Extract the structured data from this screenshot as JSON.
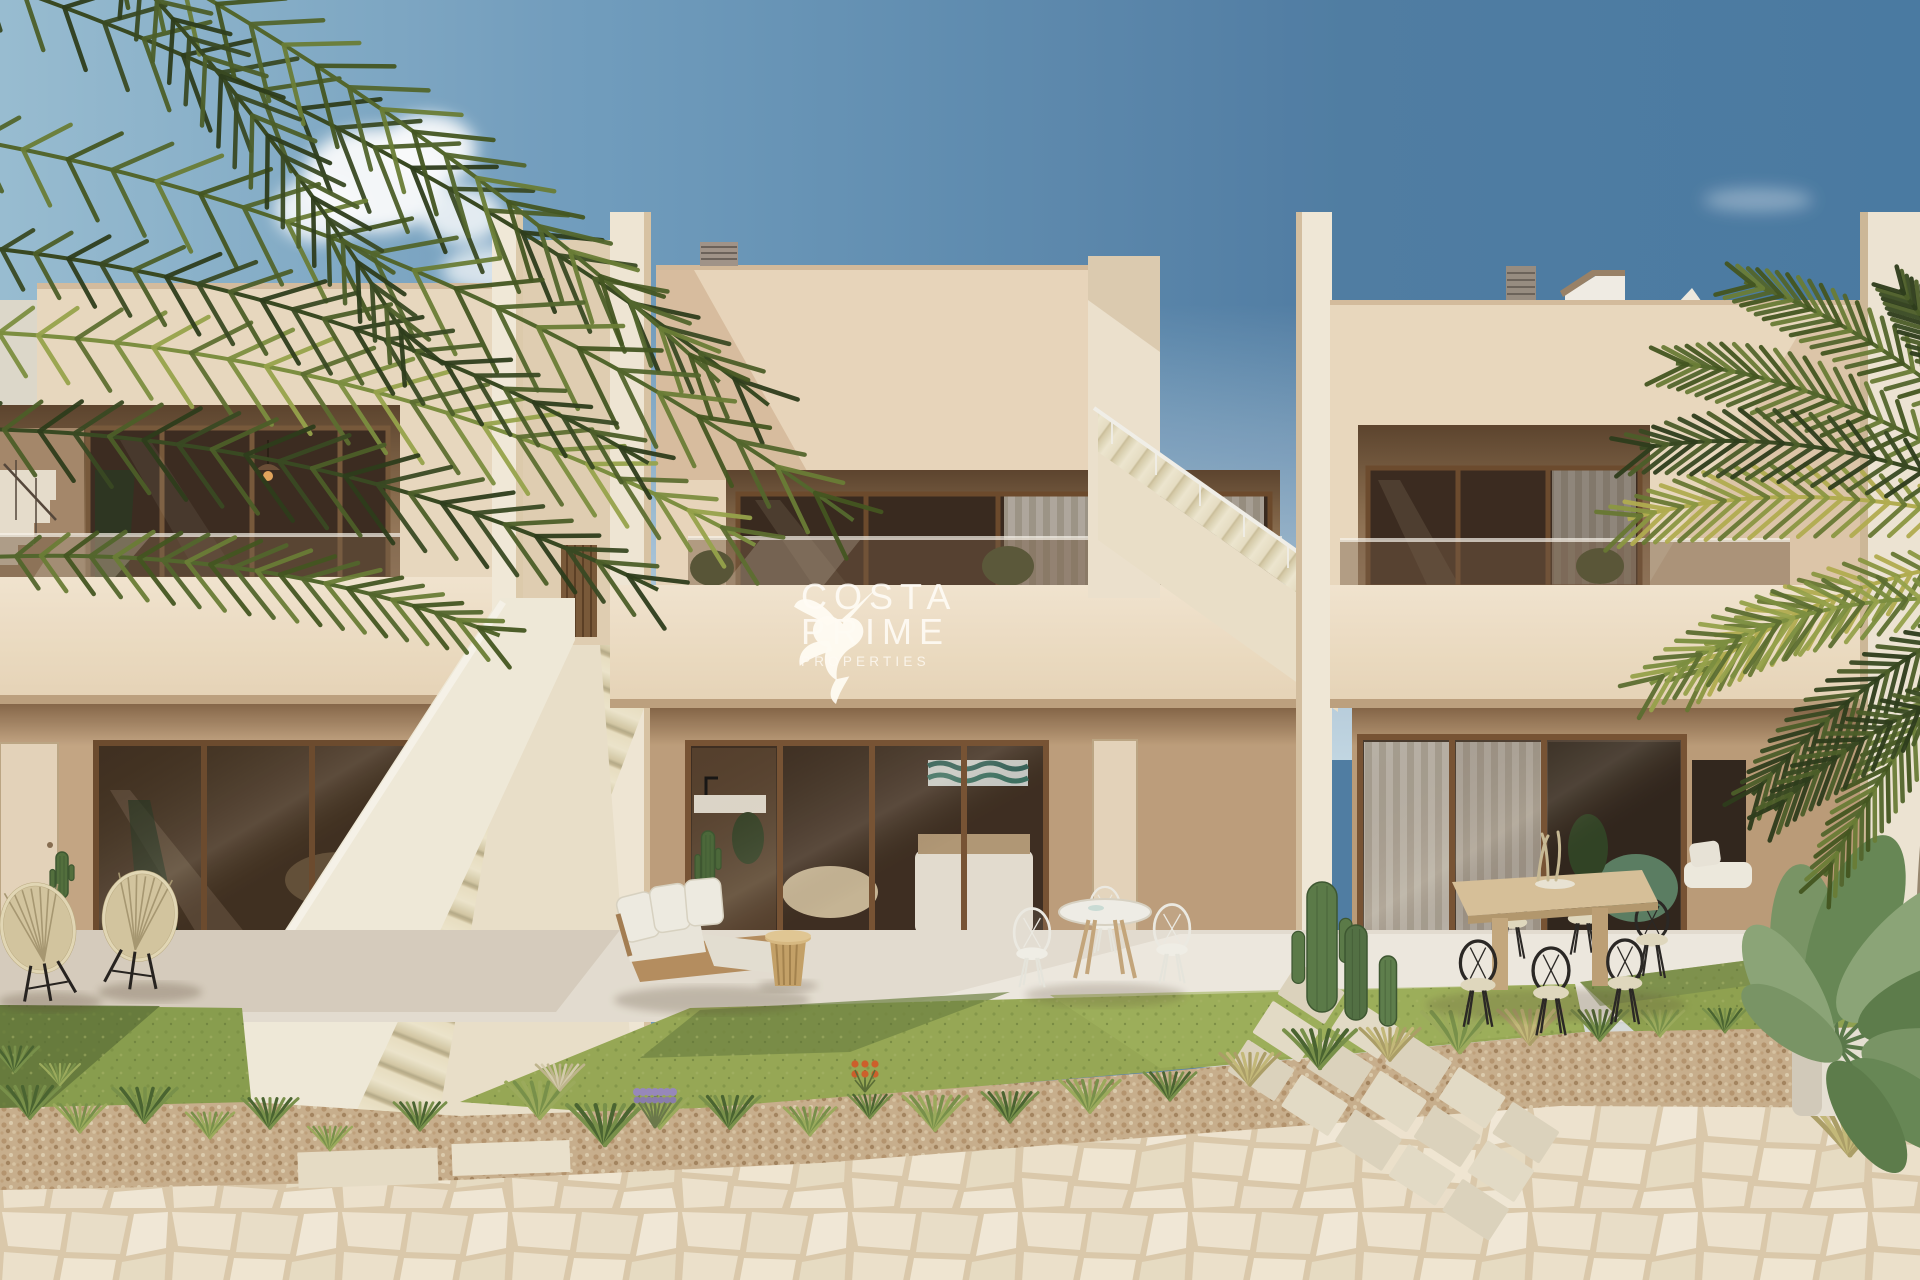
{
  "watermark": {
    "brand_line1": "COSTA",
    "brand_line2": "PRIME",
    "brand_line3": "PROPERTIES",
    "logo_icon": "hummingbird-icon",
    "color": "#FFFFFF"
  },
  "palette": {
    "sky_deep_blue": "#4f82aa",
    "sky_light_blue": "#a6c6da",
    "wall_lit_cream": "#f2e4cb",
    "wall_tan_shade": "#c7a884",
    "recess_brown": "#6e5138",
    "glass_frame_brown": "#6f4c2d",
    "glass_dark": "#3d2c1f",
    "lawn_green": "#97a751",
    "gravel_tan": "#cdb28e",
    "stone_paving": "#f0e4cd",
    "foliage_green": "#55682c"
  },
  "scene": {
    "description": "3D architectural rendering of a modern two-storey beige townhouse row with glass balconies, external staircases, palm trees and landscaped patios",
    "units": [
      "left-townhouse",
      "center-townhouse",
      "right-townhouse"
    ]
  }
}
